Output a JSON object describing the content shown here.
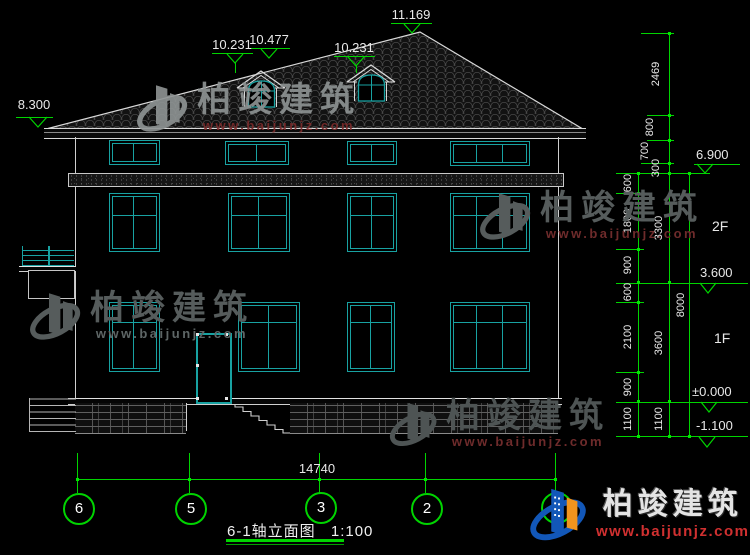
{
  "title": {
    "name": "6-1轴立面图",
    "scale": "1:100"
  },
  "levels": {
    "top": [
      "8.300",
      "10.231",
      "10.477",
      "10.231",
      "11.169"
    ],
    "right": [
      "6.900",
      "3.600",
      "±0.000",
      "-1.100"
    ]
  },
  "floors": [
    "2F",
    "1F"
  ],
  "dims": {
    "roof": [
      "2469",
      "800",
      "700",
      "300"
    ],
    "inner": [
      "600",
      "1800",
      "900",
      "600",
      "2100",
      "900",
      "1100"
    ],
    "story": [
      "3300",
      "3600",
      "1100"
    ],
    "total_height": "8000",
    "total_width": "14740"
  },
  "axes": [
    "6",
    "5",
    "3",
    "2",
    "1"
  ],
  "watermark": {
    "brand": "柏竣建筑",
    "url": "www.baijunjz.com"
  },
  "colors": {
    "dim_green": "#00d400",
    "window_teal": "#18a2a2",
    "line_white": "#d9d9d9",
    "brand_red": "#d03030",
    "logo_blue": "#1257b8",
    "logo_orange": "#f0941e"
  }
}
